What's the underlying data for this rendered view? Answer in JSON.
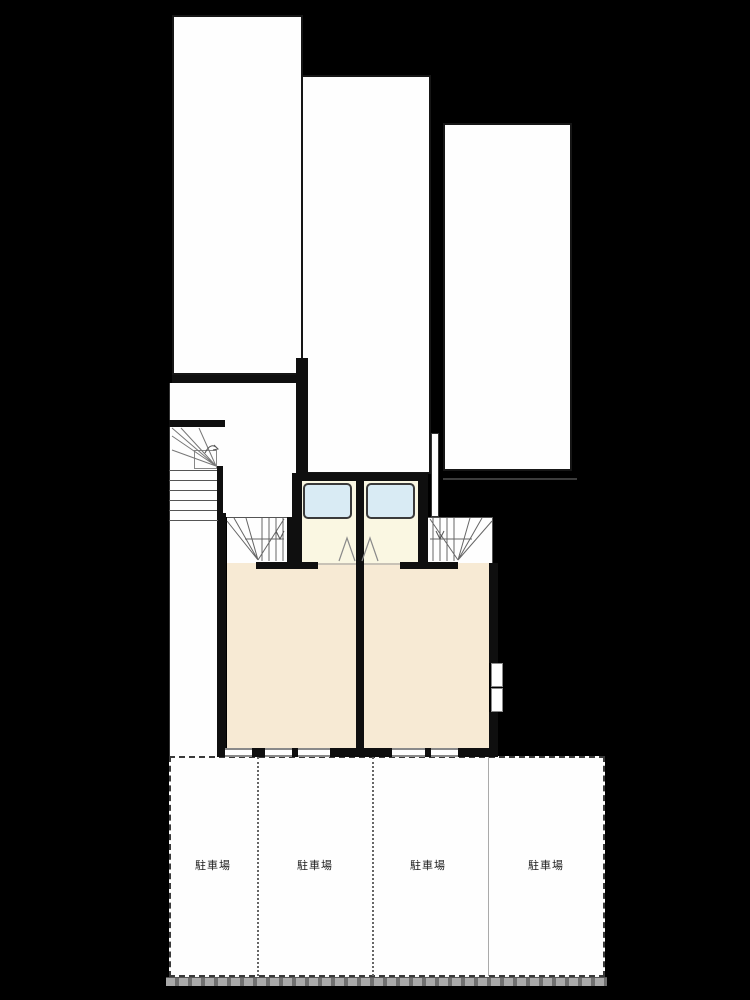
{
  "colors": {
    "background": "#000000",
    "site": "#fefefe",
    "room": "#f7ead4",
    "entry": "#faf7e2",
    "glass": "#d9ebf4",
    "wall": "#0f0f0f",
    "road": "#9a9a9a"
  },
  "parking": {
    "stalls": [
      {
        "label": "駐車場"
      },
      {
        "label": "駐車場"
      },
      {
        "label": "駐車場"
      },
      {
        "label": "駐車場"
      }
    ]
  }
}
